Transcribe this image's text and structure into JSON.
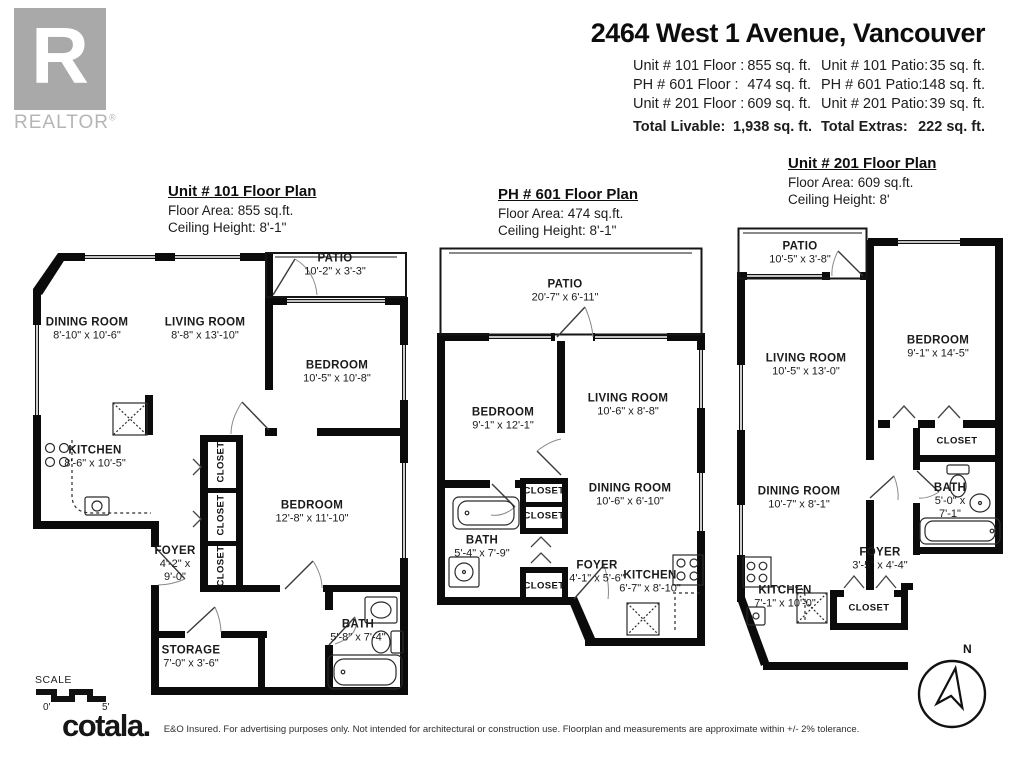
{
  "branding": {
    "realtor_letter": "R",
    "realtor_wordmark": "REALTOR",
    "registered_symbol": "®",
    "cotala_logo": "cotala.",
    "disclaimer": "E&O Insured. For advertising purposes only. Not intended for architectural or construction use. Floorplan and measurements are approximate within +/- 2% tolerance."
  },
  "header": {
    "title": "2464 West 1 Avenue, Vancouver",
    "rows": [
      {
        "l1": "Unit # 101 Floor :",
        "v1": "855 sq. ft.",
        "l2": "Unit # 101 Patio:",
        "v2": "35 sq. ft."
      },
      {
        "l1": "PH # 601 Floor :",
        "v1": "474 sq. ft.",
        "l2": "PH # 601 Patio:",
        "v2": "148 sq. ft."
      },
      {
        "l1": "Unit # 201 Floor :",
        "v1": "609 sq. ft.",
        "l2": "Unit # 201 Patio:",
        "v2": "39 sq. ft."
      }
    ],
    "totals": {
      "l1": "Total Livable:",
      "v1": "1,938 sq. ft.",
      "l2": "Total Extras:",
      "v2": "222 sq. ft."
    }
  },
  "unit101": {
    "title": "Unit # 101 Floor Plan",
    "floor_area": "Floor Area: 855 sq.ft.",
    "ceiling": "Ceiling Height: 8'-1\"",
    "patio": {
      "name": "PATIO",
      "dims": "10'-2\" x 3'-3\""
    },
    "dining": {
      "name": "DINING ROOM",
      "dims": "8'-10\" x 10'-6\""
    },
    "living": {
      "name": "LIVING ROOM",
      "dims": "8'-8\" x 13'-10\""
    },
    "bedroom1": {
      "name": "BEDROOM",
      "dims": "10'-5\" x 10'-8\""
    },
    "kitchen": {
      "name": "KITCHEN",
      "dims": "8'-6\" x 10'-5\""
    },
    "bedroom2": {
      "name": "BEDROOM",
      "dims": "12'-8\" x 11'-10\""
    },
    "foyer": {
      "name": "FOYER",
      "dims1": "4'-2\" x",
      "dims2": "9'-0\""
    },
    "storage": {
      "name": "STORAGE",
      "dims": "7'-0\" x 3'-6\""
    },
    "bath": {
      "name": "BATH",
      "dims": "5'-8\" x 7'-4\""
    },
    "closet_label": "CLOSET"
  },
  "unit601": {
    "title": "PH # 601 Floor Plan",
    "floor_area": "Floor Area: 474 sq.ft.",
    "ceiling": "Ceiling Height: 8'-1\"",
    "patio": {
      "name": "PATIO",
      "dims": "20'-7\" x 6'-11\""
    },
    "bedroom": {
      "name": "BEDROOM",
      "dims": "9'-1\" x 12'-1\""
    },
    "living": {
      "name": "LIVING ROOM",
      "dims": "10'-6\" x 8'-8\""
    },
    "dining": {
      "name": "DINING ROOM",
      "dims": "10'-6\" x 6'-10\""
    },
    "bath": {
      "name": "BATH",
      "dims": "5'-4\" x 7'-9\""
    },
    "foyer": {
      "name": "FOYER",
      "dims": "4'-1\" x 5'-6\""
    },
    "kitchen": {
      "name": "KITCHEN",
      "dims": "6'-7\" x 8'-10\""
    },
    "closet_label": "CLOSET"
  },
  "unit201": {
    "title": "Unit # 201 Floor Plan",
    "floor_area": "Floor Area: 609 sq.ft.",
    "ceiling": "Ceiling Height: 8'",
    "patio": {
      "name": "PATIO",
      "dims": "10'-5\" x 3'-8\""
    },
    "living": {
      "name": "LIVING ROOM",
      "dims": "10'-5\" x 13'-0\""
    },
    "bedroom": {
      "name": "BEDROOM",
      "dims": "9'-1\" x 14'-5\""
    },
    "bath": {
      "name": "BATH",
      "dims1": "5'-0\" x",
      "dims2": "7'-1\""
    },
    "dining": {
      "name": "DINING ROOM",
      "dims": "10'-7\" x 8'-1\""
    },
    "foyer": {
      "name": "FOYER",
      "dims": "3'-5\" x 4'-4\""
    },
    "kitchen": {
      "name": "KITCHEN",
      "dims": "7'-1\" x 10'-0\""
    },
    "closet_label": "CLOSET"
  },
  "scale": {
    "label": "SCALE",
    "start": "0'",
    "end": "5'"
  },
  "compass": {
    "north_label": "N"
  }
}
